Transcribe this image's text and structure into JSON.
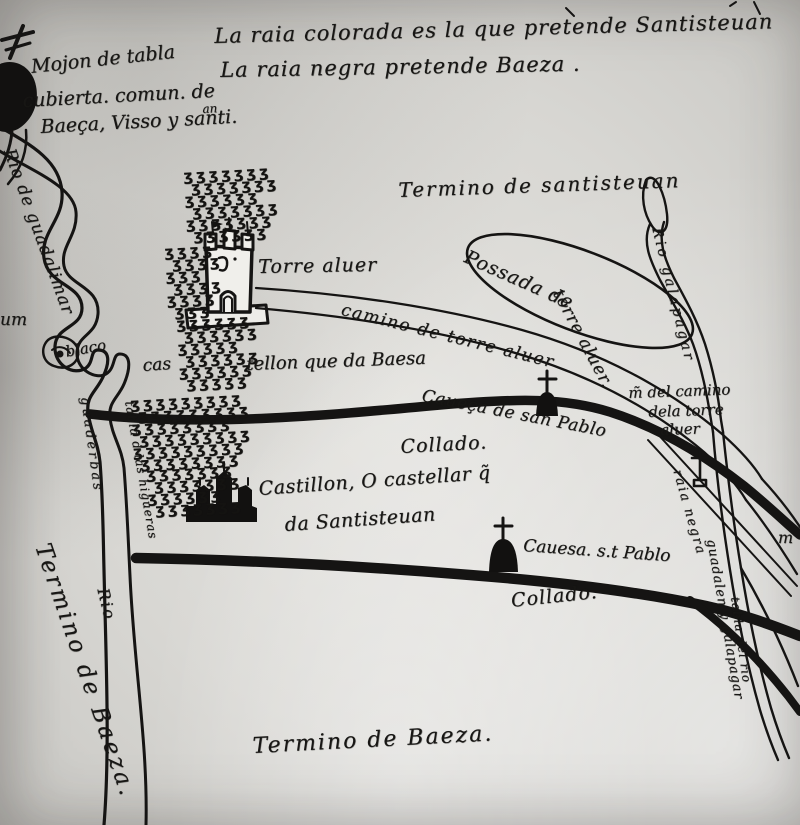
{
  "legend": {
    "line1": "La raia colorada es la que pretende Santisteuan",
    "line2": "La raia negra pretende Baeza ."
  },
  "mojon_note": {
    "line1": "Mojon de tabla",
    "line2": "cubierta. comun. de",
    "line3": "Baeça, Visso y santi.",
    "superscript": "an"
  },
  "territories": {
    "santisteuan": "Termino de santisteuan",
    "baeza_bottom": "Termino de Baeza.",
    "baeza_left": "Termino de Baeza."
  },
  "rivers": {
    "guadalimar": "Rio de guadalimar",
    "galapagar": "Rio galapagar",
    "guadalen_galapagar": "guadalen y galapagar",
    "tabla_del_rio": "tabla del rio",
    "tabla_higueras": "tabla d las higueras",
    "guaderbas": "guaderbas",
    "rio": "Rio"
  },
  "features": {
    "torre_aluer": "Torre aluer",
    "possada_line1": "Possada de",
    "possada_line2": "torre aluer.",
    "camino": "camino de torre aluer",
    "castellon_prefix": "cas",
    "castellon_hill": "tellon que da Baesa",
    "cabeza_san_pablo": "Caueça de san Pablo",
    "collado_upper": "Collado.",
    "castillon_line1": "Castillon, O castellar q̃",
    "castillon_line2": "da Santisteuan",
    "cabeza_st_pablo": "Cauesa. s.t Pablo",
    "collado_lower": "Collado.",
    "mojon_camino_line1": "m̃ del camino",
    "mojon_camino_line2": "dela torre",
    "mojon_camino_line3": "aluer",
    "raia_negra": "raia negra",
    "blaco": "blaco",
    "um_fragment": "um",
    "m_fragment": "m"
  },
  "terrain": {
    "hatch_glyph": "ʒ"
  },
  "colors": {
    "ink": "#161514",
    "paper": "#d8d7d3"
  }
}
